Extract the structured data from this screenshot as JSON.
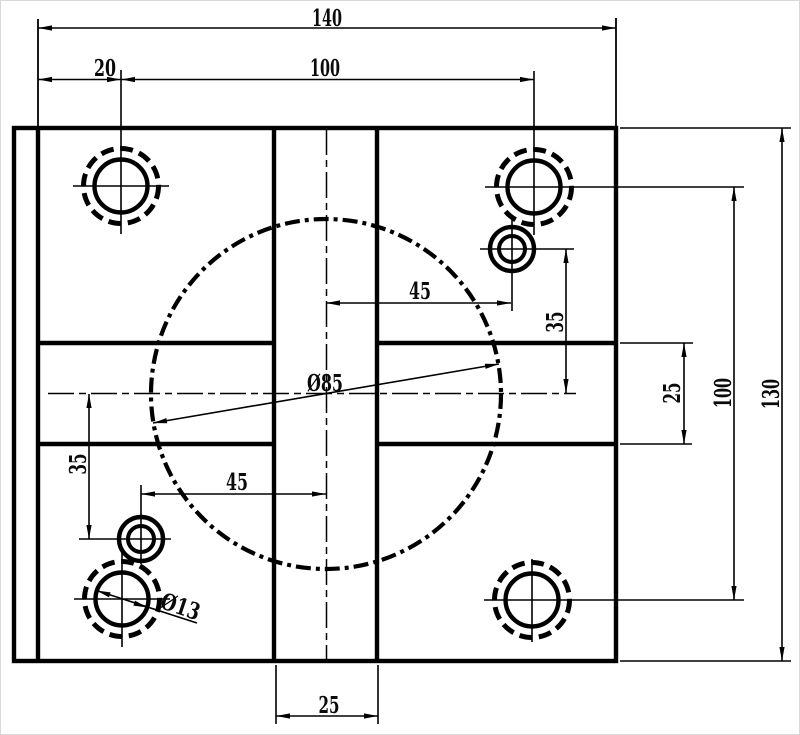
{
  "drawing": {
    "type": "mechanical-part-orthographic-view",
    "units": "mm",
    "line_color": "#000000",
    "background_color": "#ffffff",
    "part": {
      "description_labels": {
        "center_bore_diameter": "Ø85",
        "corner_hole_diameter": "Ø13"
      }
    },
    "dimensions": {
      "overall_width": "140",
      "corner_hole_offset_x": "20",
      "corner_hole_pitch_x": "100",
      "overall_height": "130",
      "corner_hole_pitch_y": "100",
      "channel_width_right": "25",
      "small_hole_offset_x_top": "45",
      "small_hole_offset_y_top": "35",
      "small_hole_offset_x_bottom": "45",
      "small_hole_offset_y_bottom": "35",
      "channel_width_bottom": "25"
    }
  }
}
